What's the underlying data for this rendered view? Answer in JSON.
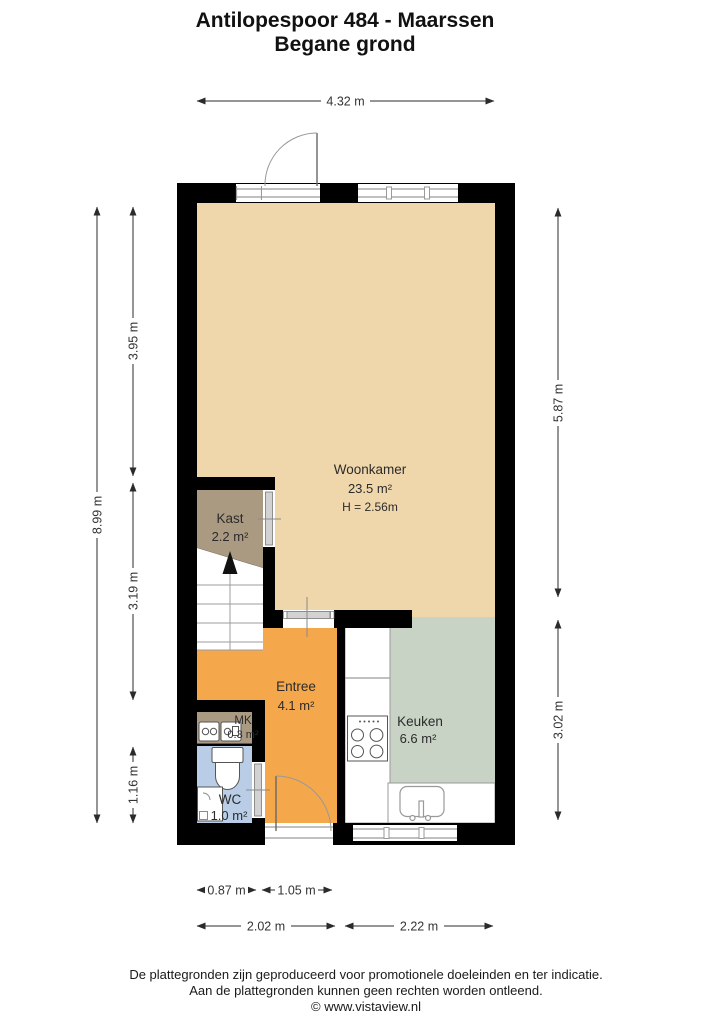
{
  "title": {
    "line1": "Antilopespoor 484 - Maarssen",
    "line2": "Begane grond"
  },
  "rooms": [
    {
      "id": "woonkamer",
      "name": "Woonkamer",
      "area": "23.5 m²",
      "height_note": "H = 2.56m",
      "color": "#f0d7ab"
    },
    {
      "id": "kast",
      "name": "Kast",
      "area": "2.2 m²",
      "color": "#ab9a82"
    },
    {
      "id": "entree",
      "name": "Entree",
      "area": "4.1 m²",
      "color": "#f5a74c"
    },
    {
      "id": "mk",
      "name": "MK",
      "area": "0.3 m²",
      "color": "#ab9a82"
    },
    {
      "id": "wc",
      "name": "WC",
      "area": "1.0 m²",
      "color": "#b9cee6"
    },
    {
      "id": "keuken",
      "name": "Keuken",
      "area": "6.6 m²",
      "color": "#c8d2c5"
    }
  ],
  "dims": {
    "top_width": "4.32 m",
    "left_total": "8.99 m",
    "left_segments": [
      "3.95 m",
      "3.19 m",
      "1.16 m"
    ],
    "right_segments": [
      "5.87 m",
      "3.02 m"
    ],
    "bottom_small": [
      "0.87 m",
      "1.05 m"
    ],
    "bottom_main": [
      "2.02 m",
      "2.22 m"
    ]
  },
  "footer": {
    "line1": "De plattegronden zijn geproduceerd voor promotionele doeleinden en ter indicatie.",
    "line2": "Aan de plattegronden kunnen geen rechten worden ontleend.",
    "line3": "© www.vistaview.nl"
  },
  "colors": {
    "wall": "#000000",
    "dimension": "#2b2b2b",
    "window_frame": "#9a9a9a",
    "door": "#d2d2d2",
    "background": "#ffffff"
  }
}
